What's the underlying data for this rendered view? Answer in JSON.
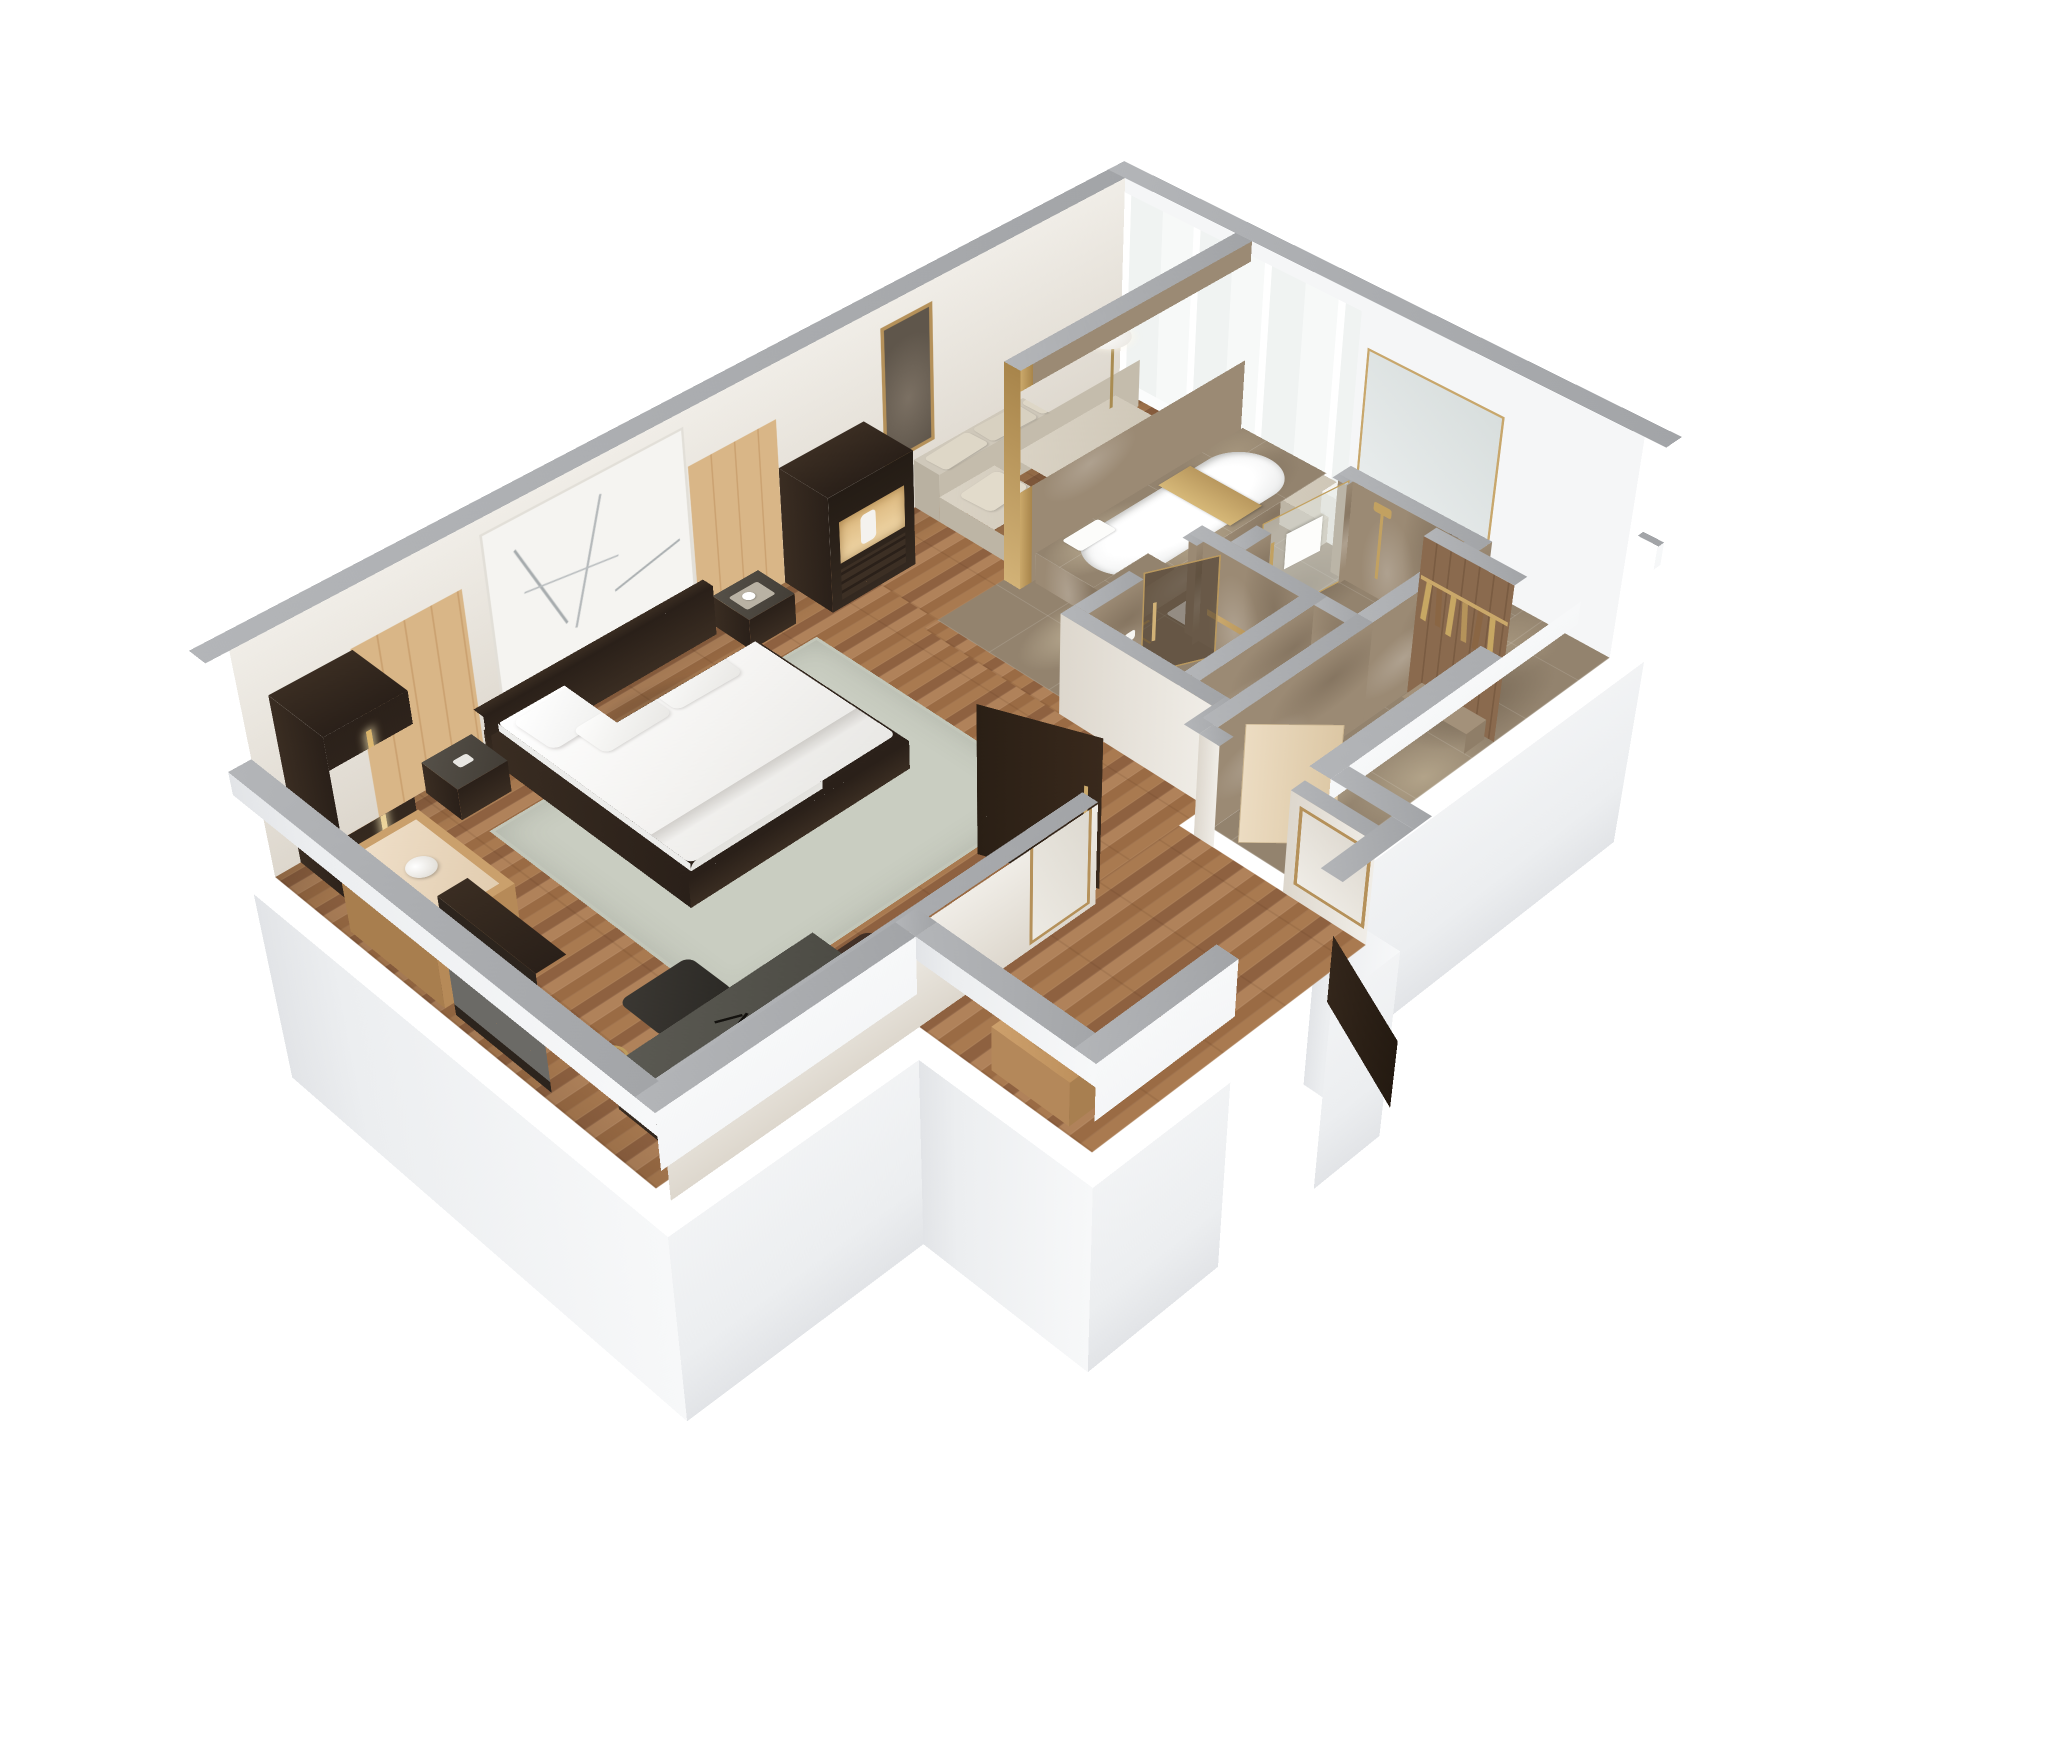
{
  "meta": {
    "title": "Hotel suite 3D isometric floor plan render",
    "view": "axonometric cutaway from above",
    "background": "#ffffff"
  },
  "palette": {
    "wood_floor": "#a97a50",
    "marble_floor": "#93836e",
    "wall_top_gray": "#a7a9ac",
    "wall_exterior_white": "#f4f5f7",
    "wall_interior_cream": "#e7e1d7",
    "oak_panel": "#d9b687",
    "dark_wood": "#32281e",
    "linen_white": "#ffffff",
    "sofa_greige": "#d5cec0",
    "brass_gold": "#b9985e",
    "rug_sage": "#c9cdc1",
    "glass": "#eef1ef"
  },
  "rooms": {
    "bedroom": {
      "label": "Bedroom / living area"
    },
    "nook": {
      "label": "Sofa nook by windows"
    },
    "entry": {
      "label": "Entry hall"
    },
    "closet": {
      "label": "Walk-in closet"
    },
    "wc": {
      "label": "WC"
    },
    "shower": {
      "label": "Shower room"
    },
    "bathroom": {
      "label": "Bathroom with tub and vanity"
    }
  },
  "furniture": {
    "kingBed": {
      "label": "King bed with white duvet and pillows"
    },
    "headboard": {
      "label": "Dark wood headboard"
    },
    "nightstandL": {
      "label": "Left nightstand"
    },
    "nightstandR": {
      "label": "Right nightstand with coffee tray"
    },
    "rug": {
      "label": "Area rug"
    },
    "wallArt": {
      "label": "Abstract line art panel above bed"
    },
    "oakPanels": {
      "label": "Oak wall paneling"
    },
    "wardrobe": {
      "label": "Dark wardrobe with lit handle"
    },
    "shelfUnit": {
      "label": "Open shelf unit with vase"
    },
    "standMirror": {
      "label": "Standing mirror"
    },
    "desk": {
      "label": "Writing desk"
    },
    "deskChair": {
      "label": "Desk chair"
    },
    "loungeChair": {
      "label": "Leather lounge chair"
    },
    "tvCabinet": {
      "label": "TV cabinet with lit niche"
    },
    "framedArt": {
      "label": "Gold framed artwork"
    },
    "floorLamp": {
      "label": "Brass floor lamp with glass globe"
    },
    "sofa": {
      "label": "Sectional sofa with chaise"
    },
    "windowBench": {
      "label": "Window bench seat"
    },
    "coffeeTable": {
      "label": "Round coffee table with brass bowl"
    },
    "partition": {
      "label": "Marble partition wall with brass trim"
    },
    "bathtub": {
      "label": "Bathtub with marble deck"
    },
    "tubTray": {
      "label": "Brass bath tray"
    },
    "tubTowels": {
      "label": "White towels"
    },
    "floorFaucet": {
      "label": "Brass floor-mounted tub filler"
    },
    "wallSpeaker": {
      "label": "Black wall-mounted fixture"
    },
    "vanity": {
      "label": "Vanity counter with basin"
    },
    "vanityMirror": {
      "label": "Vanity mirror"
    },
    "toilet": {
      "label": "Toilet"
    },
    "showerGlass": {
      "label": "Glass shower door with brass handle"
    },
    "showerSet": {
      "label": "Brass shower fixture"
    },
    "hangerWall": {
      "label": "Closet rail with hangers"
    },
    "luggageBench": {
      "label": "Closet bench"
    },
    "console": {
      "label": "Entry console with vase"
    },
    "mirrorHall1": {
      "label": "Gold framed hall mirror"
    },
    "mirrorHall2": {
      "label": "Gold framed entry mirror"
    },
    "doorBedroom": {
      "label": "Bedroom door"
    },
    "doorCloset": {
      "label": "Closet door"
    },
    "doorEntry": {
      "label": "Entry door"
    },
    "doorWc": {
      "label": "WC door"
    },
    "windows": {
      "label": "Floor-to-ceiling windows"
    }
  }
}
